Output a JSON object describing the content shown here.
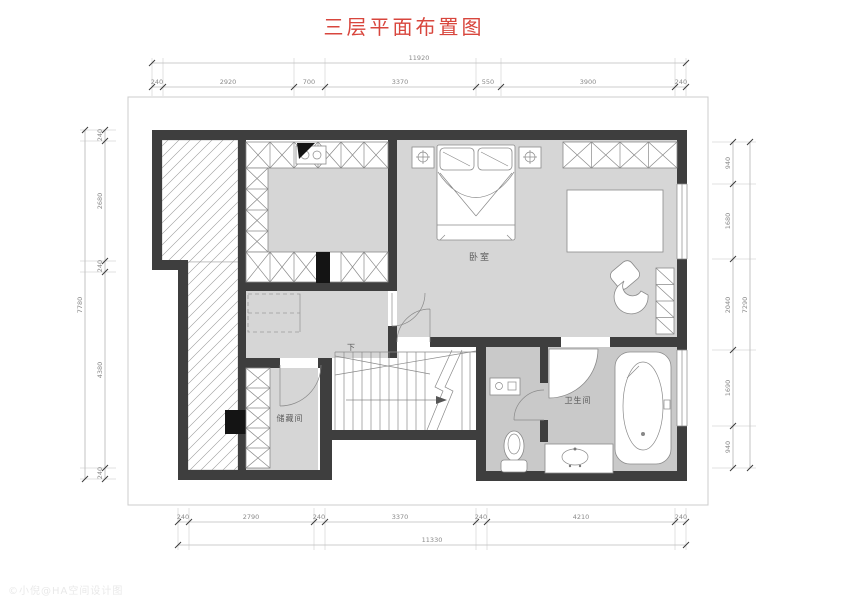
{
  "title": "三层平面布置图",
  "colors": {
    "title_red": "#d8463d",
    "wall_dark": "#3e3e3e",
    "room_fill": "#d6d6d6",
    "bath_fill": "#c9c9c9",
    "dim_gray": "#8a8a8a"
  },
  "rooms": {
    "bedroom": "卧室",
    "bathroom": "卫生间",
    "storage": "储藏间",
    "stair_direction": "下"
  },
  "dims": {
    "top": {
      "overall": "11920",
      "segments": [
        "240",
        "2920",
        "700",
        "3370",
        "550",
        "3900",
        "240"
      ]
    },
    "bottom": {
      "overall": "11330",
      "segments": [
        "240",
        "2790",
        "240",
        "3370",
        "240",
        "4210",
        "240"
      ]
    },
    "left": {
      "overall": "7780",
      "segments": [
        "240",
        "2680",
        "240",
        "4380",
        "240"
      ]
    },
    "right": {
      "overall": "7290",
      "segments": [
        "940",
        "1680",
        "2040",
        "1690",
        "940"
      ]
    }
  },
  "watermark": "©小倪@HA空间设计图"
}
